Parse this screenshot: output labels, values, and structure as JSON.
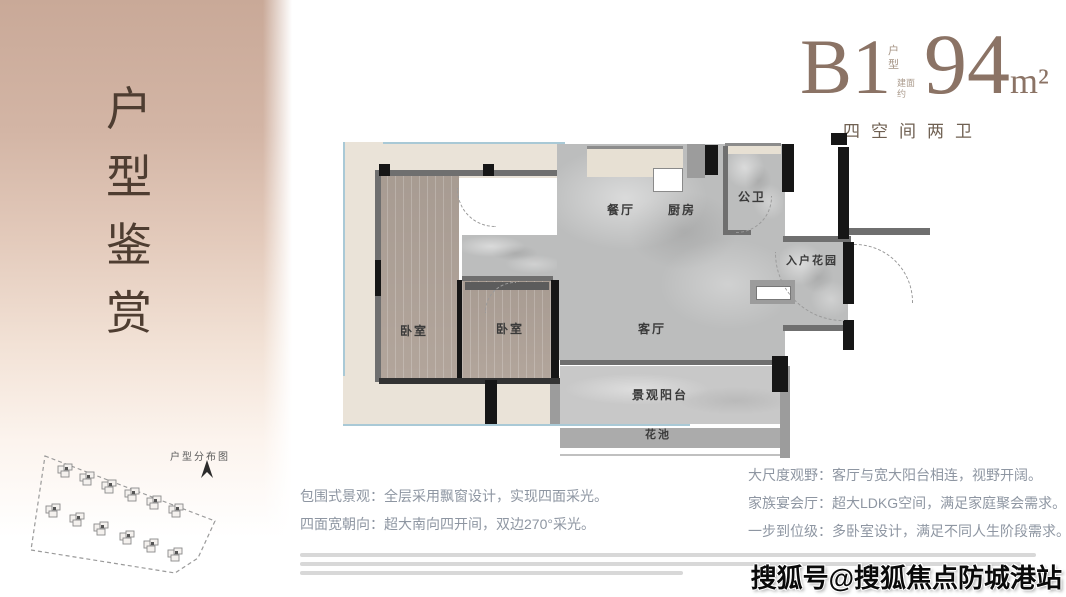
{
  "sidebar": {
    "title_chars": [
      "户",
      "型",
      "鉴",
      "赏"
    ]
  },
  "site_plan": {
    "label": "户型分布图",
    "building_count": 12
  },
  "header": {
    "unit_code": "B1",
    "unit_tag_chars": [
      "户",
      "型"
    ],
    "area_prefix_lines": [
      "建面",
      "约"
    ],
    "area_value": "94",
    "area_unit": "m²",
    "subtitle": "四空间两卫"
  },
  "floorplan": {
    "rooms": {
      "dining": "餐厅",
      "kitchen": "厨房",
      "bath": "公卫",
      "foyer": "入户花园",
      "bedroom1": "卧室",
      "bedroom2": "卧室",
      "living": "客厅",
      "balcony": "景观阳台",
      "planter": "花池"
    }
  },
  "features": {
    "left_lines": [
      "包围式景观：全层采用飘窗设计，实现四面采光。",
      "四面宽朝向：超大南向四开间，双边270°采光。"
    ],
    "right_lines": [
      "大尺度观野：客厅与宽大阳台相连，视野开阔。",
      "家族宴会厅：超大LDKG空间，满足家庭聚会需求。",
      "一步到位级：多卧室设计，满足不同人生阶段需求。"
    ]
  },
  "watermark": {
    "text": "搜狐号@搜狐焦点防城港站"
  },
  "colors": {
    "accent": "#8b7365",
    "wall_dark": "#161616",
    "wall_gray": "#6f6f6f",
    "glass": "#a9c9d6",
    "balcony_fill": "#eae3d8",
    "wood": "#b2a59b",
    "marble": "#bcbdbd"
  }
}
